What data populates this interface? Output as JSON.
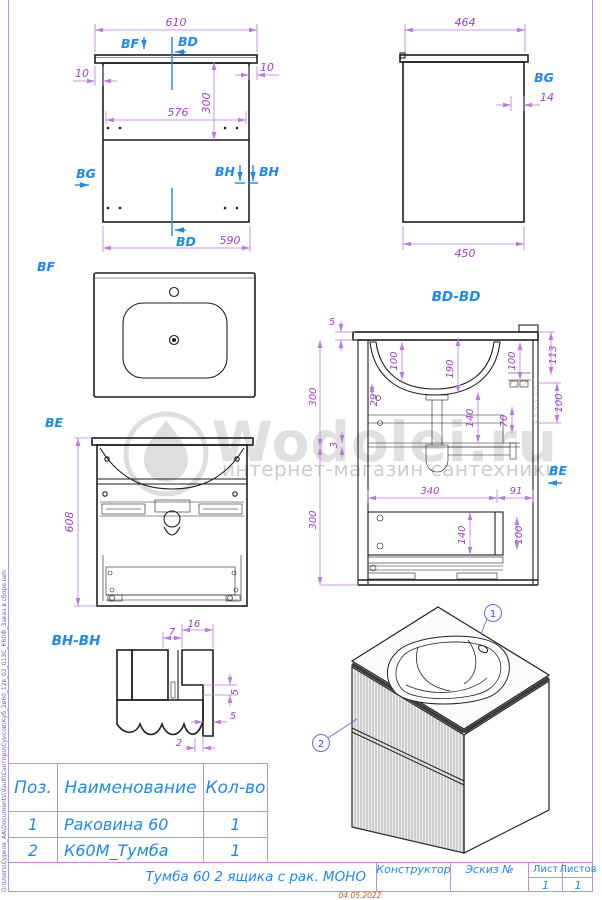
{
  "meta": {
    "file_path": "D:\\Users\\Сурков_АА\\Documents\\Vault\\Сантпро\\Сунсов\\Куб_2в60_12в_02_013С_К60Ф_Заказ в сборе.iam",
    "date": "04.05.2022"
  },
  "watermark": {
    "brand": "Wodolei.ru",
    "subtitle": "интернет-магазин сантехники"
  },
  "front_view": {
    "d610": "610",
    "d10l": "10",
    "d10r": "10",
    "d576": "576",
    "d300": "300",
    "d590": "590",
    "bf": "BF",
    "bd_top": "BD",
    "bd_bottom": "BD",
    "bg": "BG",
    "bh_left": "BH",
    "bh_right": "BH"
  },
  "side_view": {
    "d464": "464",
    "d14": "14",
    "d450": "450",
    "bg": "BG"
  },
  "bf_view": {
    "label": "BF"
  },
  "be_view": {
    "label": "BE",
    "d608": "608"
  },
  "bd_view": {
    "title": "BD-BD",
    "d5": "5",
    "d300_top": "300",
    "d100_left": "100",
    "d190": "190",
    "d100_mid": "100",
    "d113": "113",
    "d100_right": "100",
    "d29": "29",
    "d140_top": "140",
    "d70": "70",
    "d3": "3",
    "d300_bottom": "300",
    "d340": "340",
    "d91": "91",
    "d140_bottom": "140",
    "d100_bottom": "100",
    "be": "BE"
  },
  "bh_view": {
    "title": "BH-BH",
    "d7": "7",
    "d16": "16",
    "d5_step": "5",
    "d5_gap": "5",
    "d2": "2"
  },
  "iso_view": {
    "balloon_1": "1",
    "balloon_2": "2"
  },
  "parts_table": {
    "headers": {
      "pos": "Поз.",
      "name": "Наименование",
      "qty": "Кол-во"
    },
    "rows": [
      {
        "pos": "1",
        "name": "Раковина 60",
        "qty": "1"
      },
      {
        "pos": "2",
        "name": "К60М_Тумба",
        "qty": "1"
      }
    ]
  },
  "title_block": {
    "title": "Тумба 60 2 ящика с рак. МОНО",
    "constructor": "Конструктор",
    "sketch": "Эскиз №",
    "sheet_label": "Лист",
    "sheet_value": "1",
    "sheets_label": "Листов",
    "sheets_value": "1"
  },
  "colors": {
    "dimension": "#a53ccb",
    "dim_line": "#bb79e0",
    "section_blue": "#1b8af2",
    "frame_purple": "#c88be0",
    "hatch_red": "#e89a9a",
    "date_red": "#d8571c",
    "watermark_gray": "#dedede",
    "line_black": "#1e1e1e"
  }
}
